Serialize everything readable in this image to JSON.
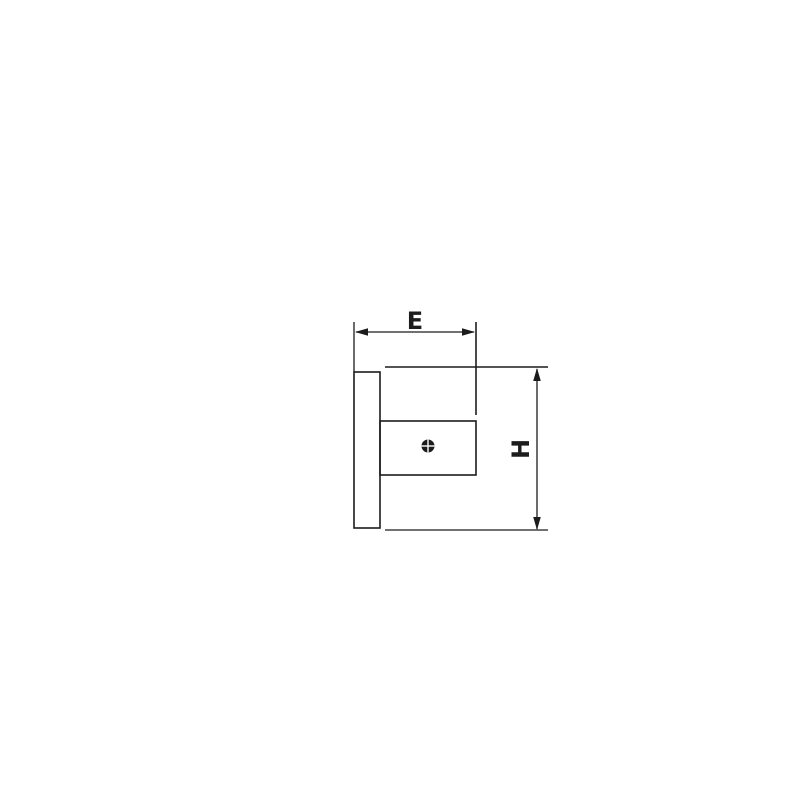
{
  "page": {
    "background_color": "#ffffff"
  },
  "drawing": {
    "kind": "technical-dimension-drawing",
    "view": "bracket-side-view",
    "line_color": "#1c1c1c",
    "dimension_labels": {
      "horizontal": "E",
      "vertical": "H"
    },
    "symbols": {
      "screw": "crosshead-screw-icon"
    }
  }
}
